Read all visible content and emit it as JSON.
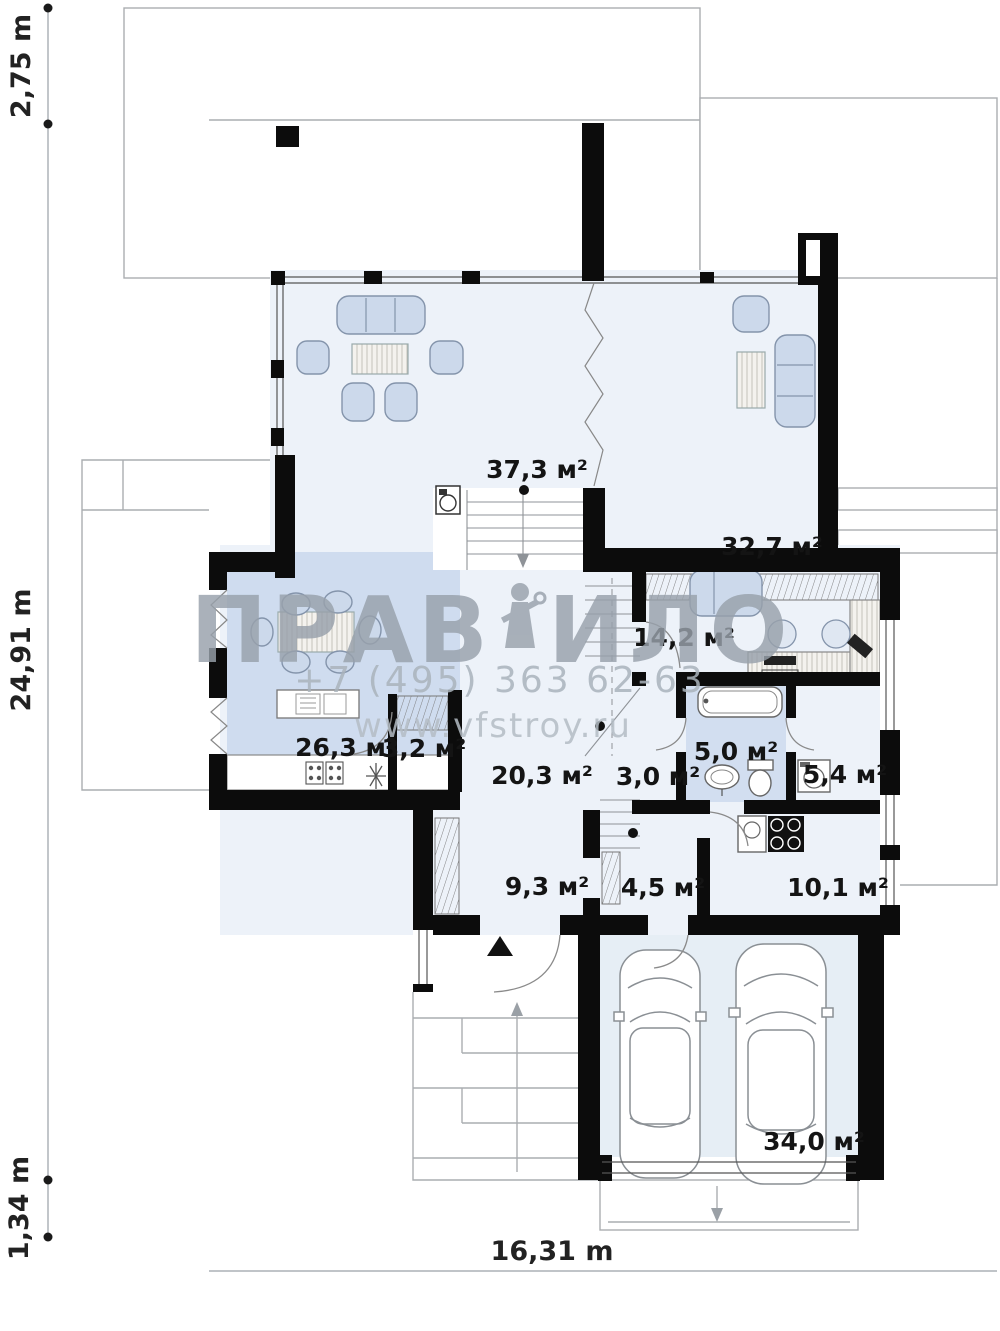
{
  "plan": {
    "rooms": [
      {
        "id": "living-dining",
        "area": "37,3 м²"
      },
      {
        "id": "salon",
        "area": "32,7 м²"
      },
      {
        "id": "cabinet",
        "area": "14,2 м²"
      },
      {
        "id": "kitchen",
        "area": "26,3 м²"
      },
      {
        "id": "pantry",
        "area": "3,2 м²"
      },
      {
        "id": "hall",
        "area": "20,3 м²"
      },
      {
        "id": "wc-lobby",
        "area": "3,0 м²"
      },
      {
        "id": "bathroom",
        "area": "5,0 м²"
      },
      {
        "id": "utility",
        "area": "5,4 м²"
      },
      {
        "id": "entry-hall",
        "area": "9,3 м²"
      },
      {
        "id": "corridor",
        "area": "4,5 м²"
      },
      {
        "id": "room",
        "area": "10,1 м²"
      },
      {
        "id": "garage",
        "area": "34,0 м²"
      }
    ],
    "dimensions": {
      "left_top": "2,75 m",
      "left_main": "24,91 m",
      "left_bottom": "1,34 m",
      "bottom": "16,31 m"
    }
  },
  "watermark": {
    "logo_left": "ПРАВ",
    "logo_right": "ИЛО",
    "phone": "+7 (495) 363 62-63",
    "website": "www.vfstroy.ru"
  },
  "colors": {
    "wall": "#0c0c0c",
    "room_fill": "#edf2f9",
    "wet_room_fill": "#cfdcef",
    "furniture": "#ccd9eb",
    "watermark": "#98a1ab"
  }
}
